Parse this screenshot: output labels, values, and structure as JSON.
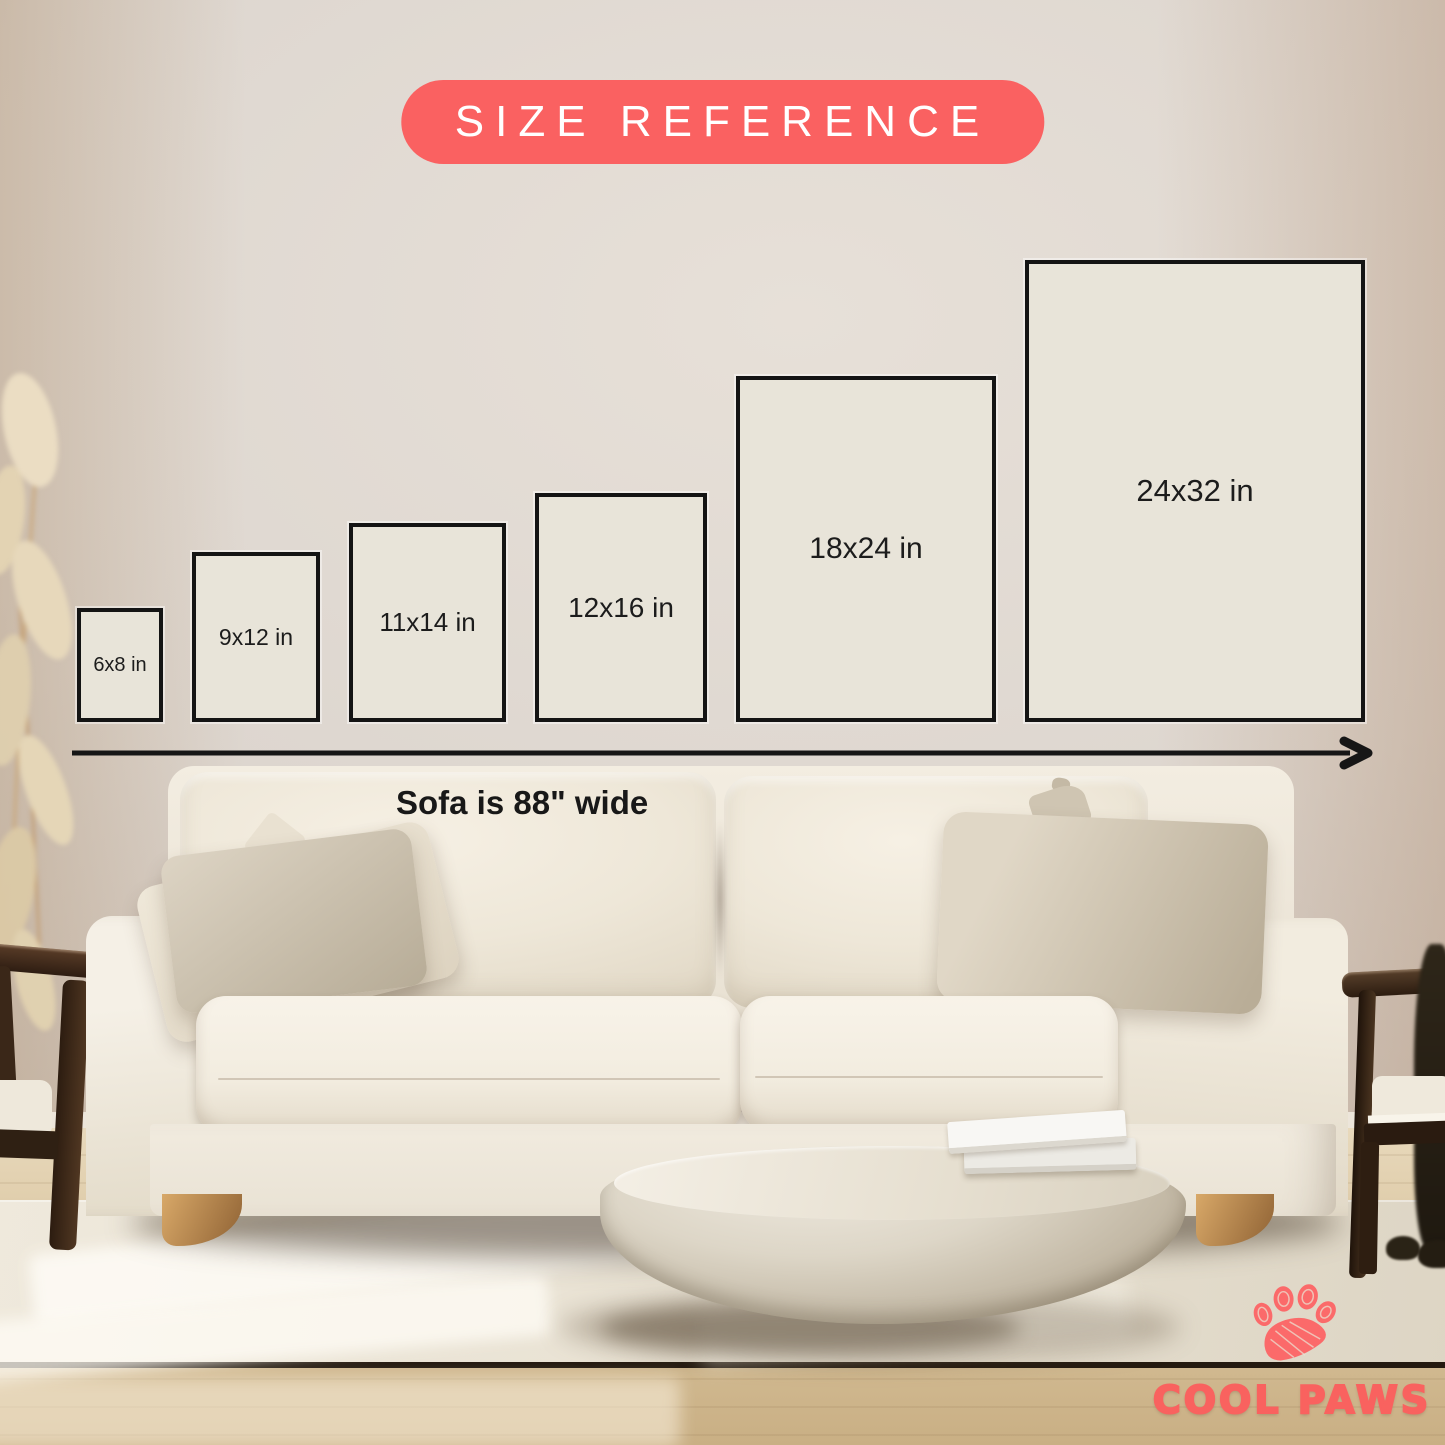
{
  "badge": {
    "label": "SIZE REFERENCE"
  },
  "frames": [
    {
      "label": "6x8 in"
    },
    {
      "label": "9x12 in"
    },
    {
      "label": "11x14 in"
    },
    {
      "label": "12x16 in"
    },
    {
      "label": "18x24 in"
    },
    {
      "label": "24x32 in"
    }
  ],
  "scale": {
    "caption": "Sofa is 88\" wide"
  },
  "brand": {
    "name": "COOL PAWS"
  },
  "icons": {
    "paw": "paw-icon",
    "width_arrow": "width-arrow-icon"
  },
  "colors": {
    "accent": "#fa6161",
    "accent_text": "#ffffff",
    "frame_fill": "#e8e4d9",
    "frame_border": "#141414",
    "label_text": "#1c1c1c",
    "brand_coral": "#f9625f"
  }
}
